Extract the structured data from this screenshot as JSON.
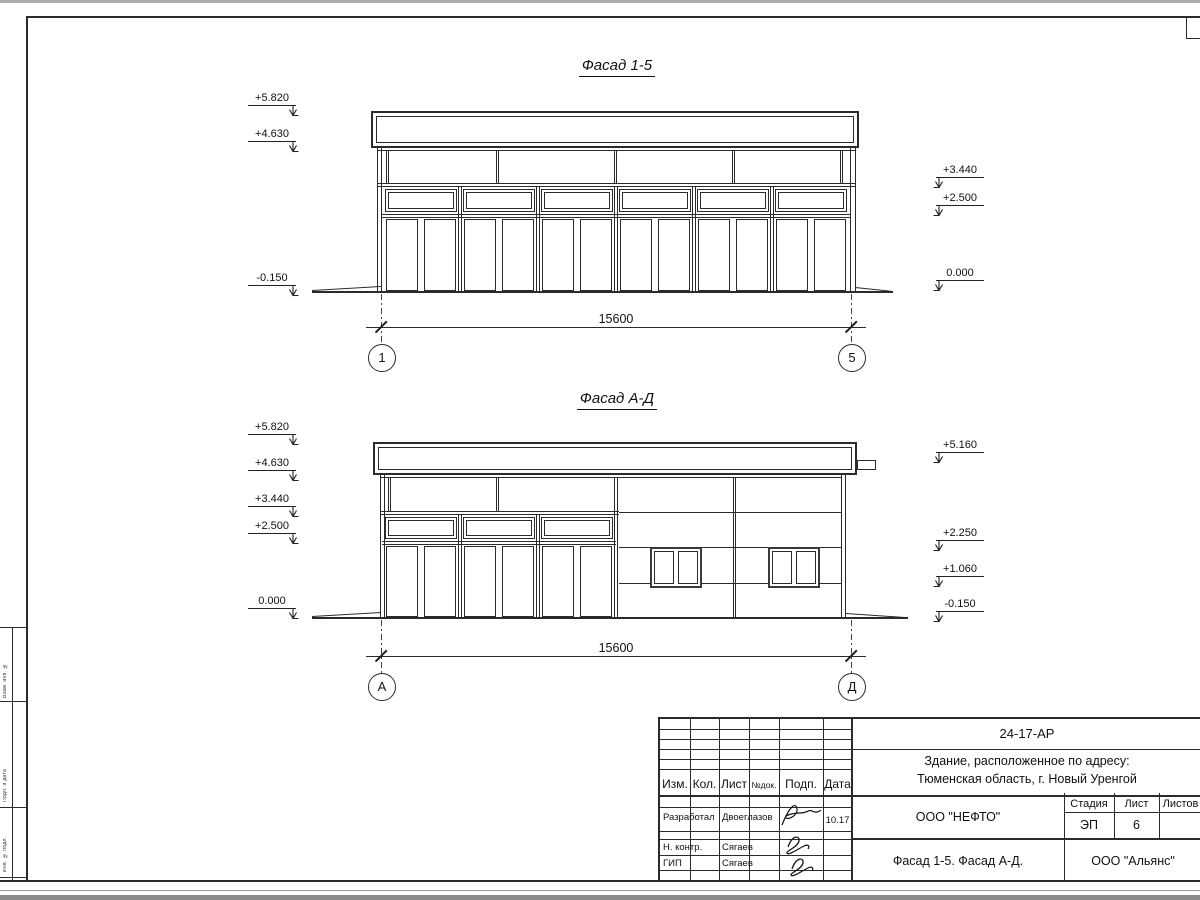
{
  "drawing": {
    "facade1": {
      "title": "Фасад 1-5",
      "dim": "15600",
      "axis_left": "1",
      "axis_right": "5",
      "elev_left": [
        "+5.820",
        "+4.630",
        "-0.150"
      ],
      "elev_right": [
        "+3.440",
        "+2.500",
        "0.000"
      ]
    },
    "facade2": {
      "title": "Фасад А-Д",
      "dim": "15600",
      "axis_left": "А",
      "axis_right": "Д",
      "elev_left": [
        "+5.820",
        "+4.630",
        "+3.440",
        "+2.500",
        "0.000"
      ],
      "elev_right": [
        "+5.160",
        "+2.250",
        "+1.060",
        "-0.150"
      ]
    }
  },
  "title_block": {
    "code": "24-17-АР",
    "address_line1": "Здание, расположенное по адресу:",
    "address_line2": "Тюменская область, г. Новый Уренгой",
    "cols": [
      "Изм.",
      "Кол.",
      "Лист",
      "№док.",
      "Подп.",
      "Дата"
    ],
    "rows": [
      {
        "role": "Разработал",
        "name": "Двоеглазов",
        "date": "10.17"
      },
      {
        "role": "Н. контр.",
        "name": "Сягаев",
        "date": ""
      },
      {
        "role": "ГИП",
        "name": "Сягаев",
        "date": ""
      }
    ],
    "org": "ООО \"НЕФТО\"",
    "stage_label": "Стадия",
    "sheet_label": "Лист",
    "sheets_label": "Листов",
    "stage": "ЭП",
    "sheet_no": "6",
    "sheets_total": "",
    "sheet_title": "Фасад 1-5. Фасад А-Д.",
    "company": "ООО \"Альянс\""
  },
  "side_stamp": {
    "labels": [
      "Взам. инв. №",
      "Подп. и дата",
      "Инв. № подл."
    ]
  }
}
